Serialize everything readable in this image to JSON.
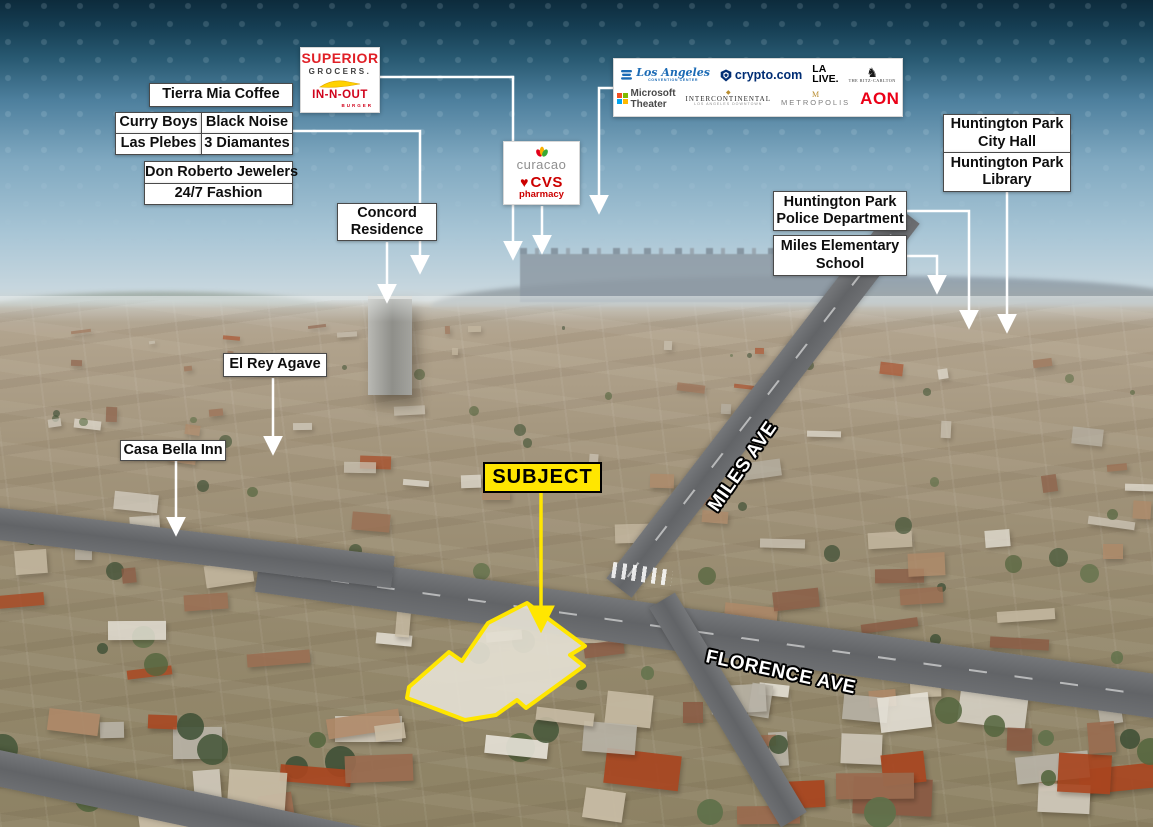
{
  "page": {
    "type": "aerial-location-map",
    "accent_yellow": "#ffe600",
    "header_navy": "#0d2b3c",
    "label_bg": "#ffffff",
    "label_text": "#0e0e0e",
    "leader_line_color": "#ffffff"
  },
  "streets": {
    "miles": "MILES AVE",
    "florence": "FLORENCE AVE"
  },
  "subject": {
    "label": "SUBJECT"
  },
  "callouts": {
    "tierra_mia": "Tierra Mia Coffee",
    "curry_boys": "Curry Boys",
    "black_noise": "Black Noise",
    "las_plebes": "Las Plebes",
    "diamantes": "3 Diamantes",
    "don_roberto": "Don Roberto Jewelers",
    "fashion": "24/7 Fashion",
    "concord": {
      "line1": "Concord",
      "line2": "Residence"
    },
    "el_rey": "El Rey Agave",
    "casa_bella": "Casa Bella Inn",
    "city_hall": {
      "line1": "Huntington Park",
      "line2": "City Hall"
    },
    "library": {
      "line1": "Huntington Park",
      "line2": "Library"
    },
    "police": {
      "line1": "Huntington Park",
      "line2": "Police Department"
    },
    "school": {
      "line1": "Miles Elementary",
      "line2": "School"
    }
  },
  "logo_boxes": {
    "superior_innout": {
      "superior": "SUPERIOR",
      "grocers": "GROCERS.",
      "innout": "IN-N-OUT",
      "burger": "BURGER"
    },
    "downtown": {
      "la_convention_script": "Los Angeles",
      "la_convention_sub": "CONVENTION CENTER",
      "crypto": "crypto.com",
      "la_live_top": "LA",
      "la_live_bottom": "LIVE.",
      "ritz_sub": "THE RITZ-CARLTON",
      "microsoft": "Microsoft Theater",
      "intercontinental": "INTERCONTINENTAL",
      "intercontinental_sub": "LOS ANGELES DOWNTOWN",
      "metropolis": "METROPOLIS",
      "metropolis_sub": "LOS ANGELES",
      "aon": "AON"
    },
    "curacao_cvs": {
      "curacao": "curacao",
      "cvs": "CVS",
      "pharmacy": "pharmacy"
    }
  },
  "icons": {
    "cvs_heart": "♥",
    "ritz_lion": "♞",
    "intercontinental_gem": "◆",
    "metropolis_m": "M"
  }
}
